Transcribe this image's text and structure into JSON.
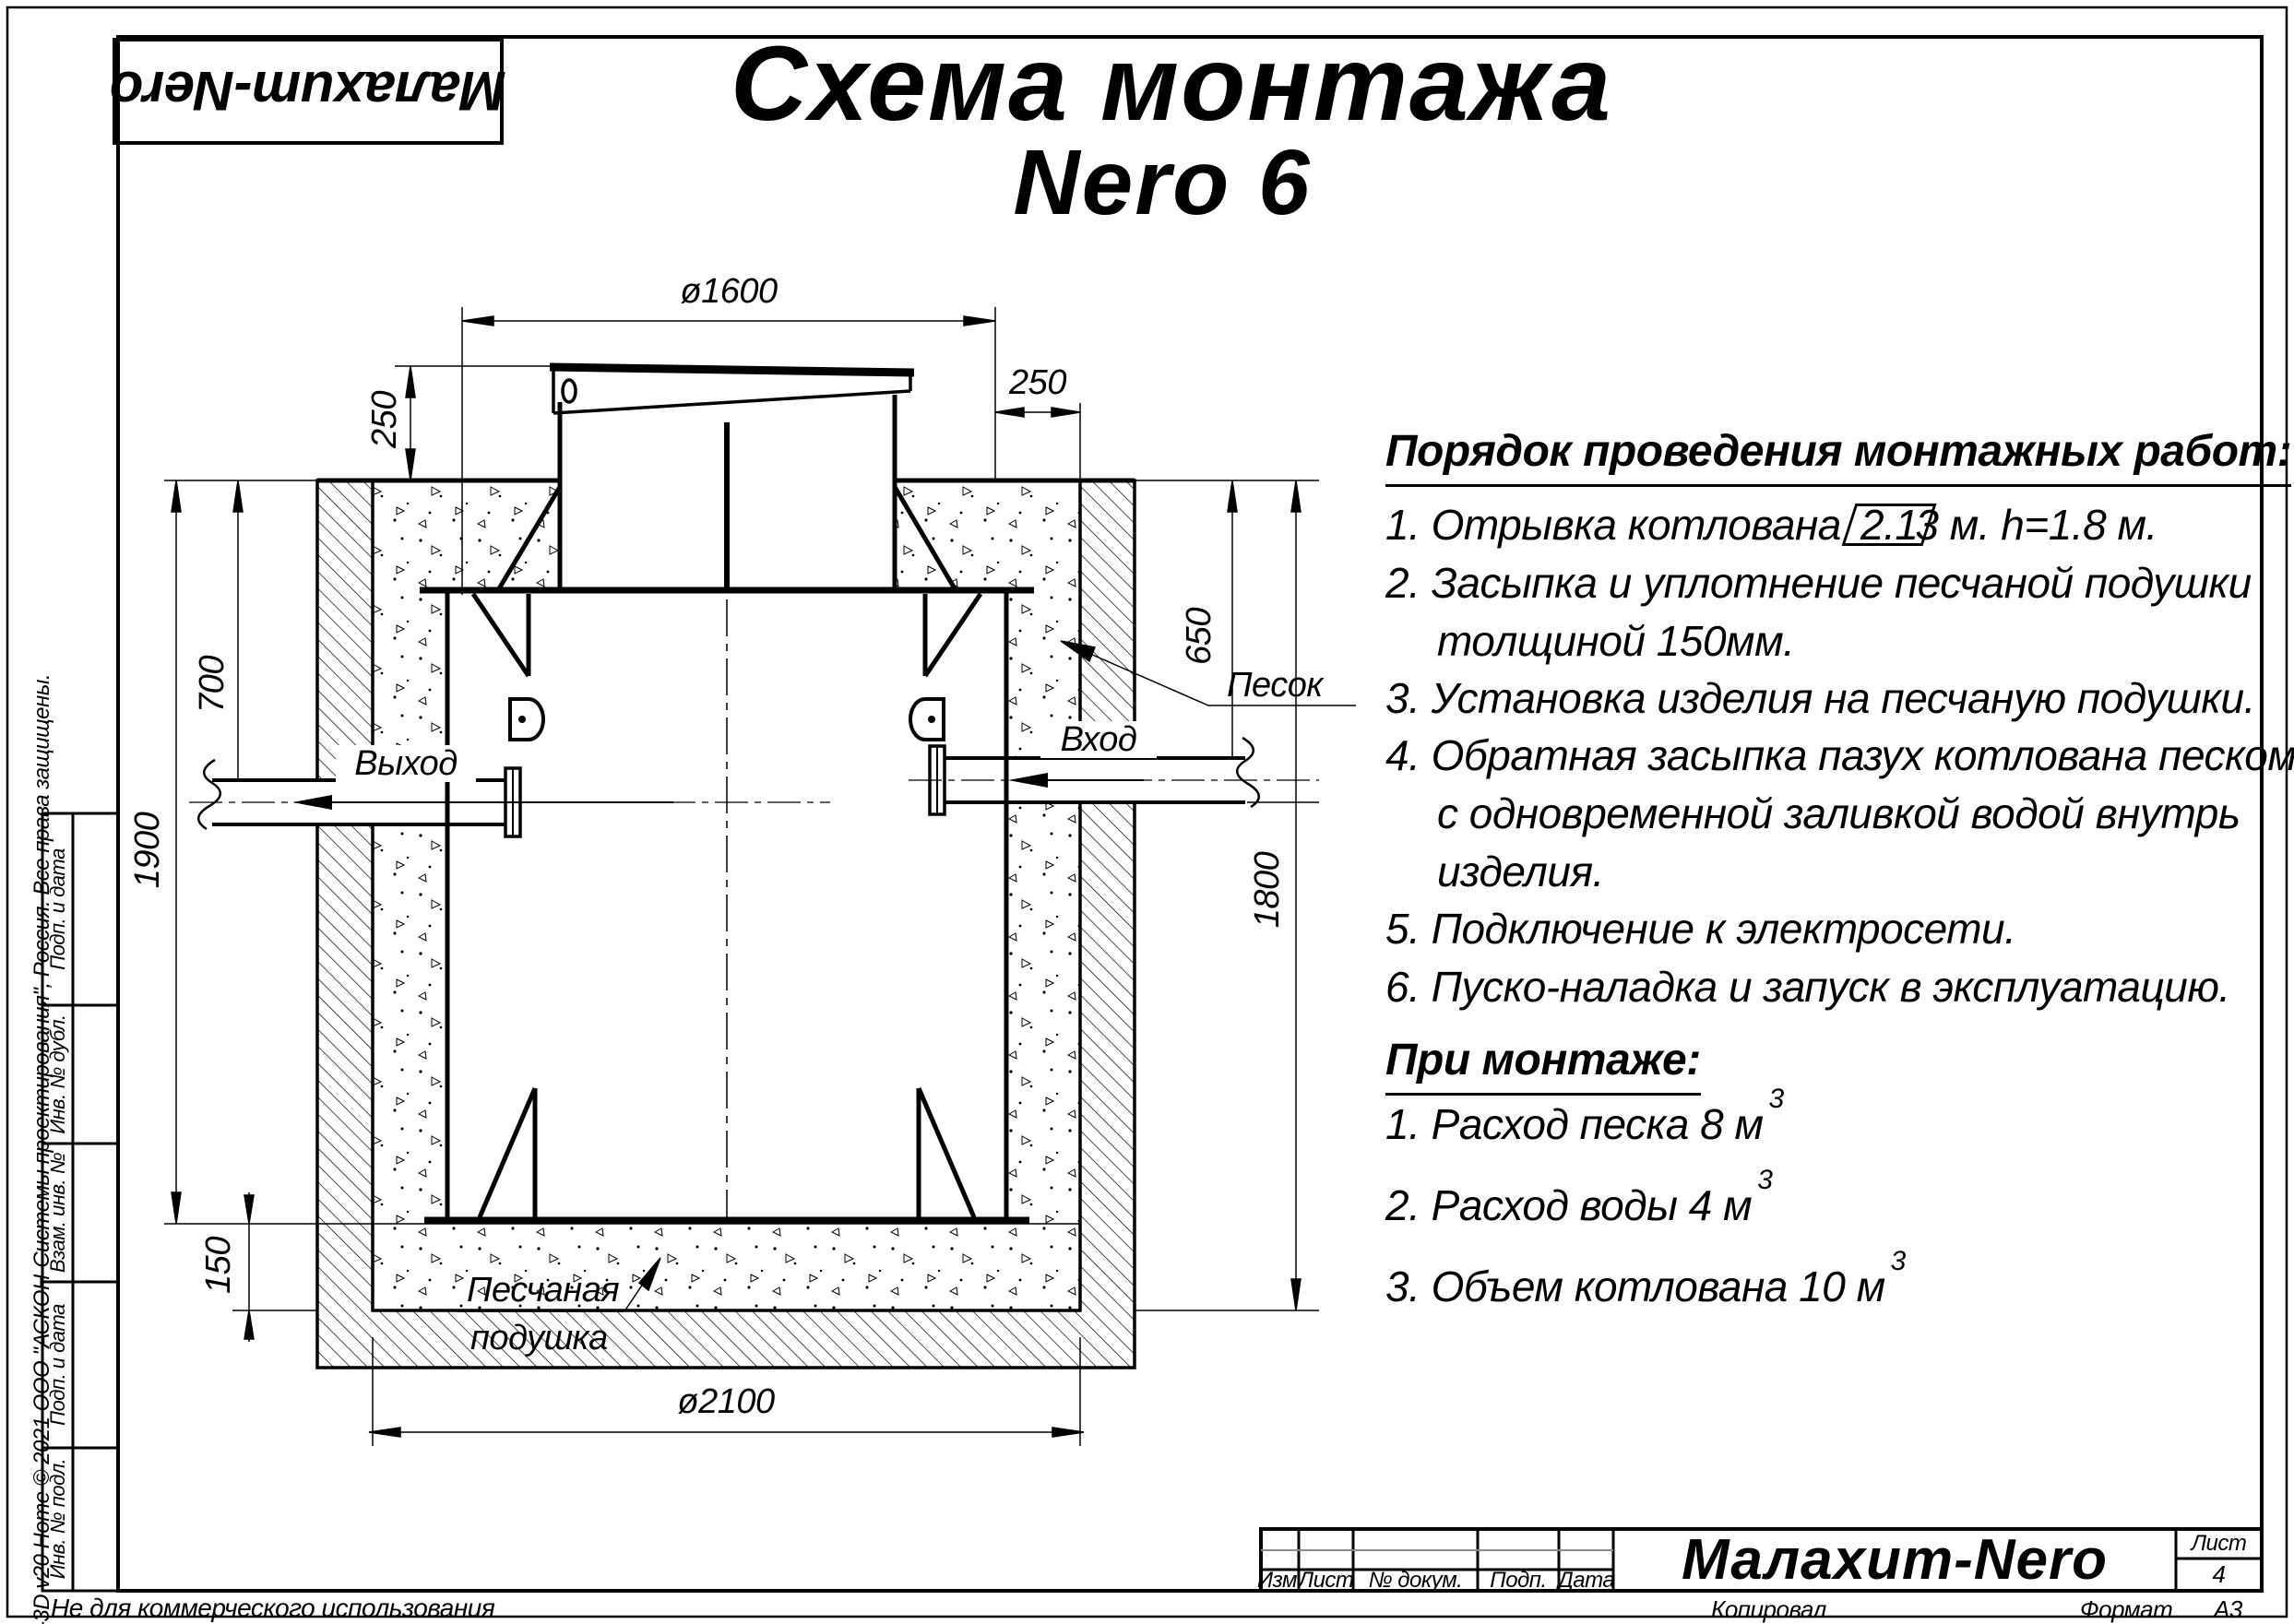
{
  "logo": {
    "text": "Малахит-Nero"
  },
  "title": {
    "line1": "Схема монтажа",
    "line2": "Nero 6"
  },
  "steps": {
    "heading": "Порядок проведения монтажных работ:",
    "s1_pre": "1. Отрывка котлована",
    "s1_box": "2.1",
    "s1_post": "3 м. h=1.8 м.",
    "s2a": "2. Засыпка и уплотнение песчаной подушки",
    "s2b": "толщиной 150мм.",
    "s3": "3. Установка изделия на песчаную подушки.",
    "s4a": "4. Обратная засыпка пазух котлована песком,",
    "s4b": "с одновременной заливкой водой внутрь",
    "s4c": "изделия.",
    "s5": "5. Подключение к электросети.",
    "s6": "6. Пуско-наладка и запуск в эксплуатацию."
  },
  "mounting": {
    "heading": "При монтаже:",
    "m1": "1. Расход песка 8 м",
    "m1_sup": "3",
    "m2": "2. Расход воды 4 м",
    "m2_sup": "3",
    "m3": "3. Объем котлована 10 м",
    "m3_sup": "3"
  },
  "dims": {
    "d1600": "ø1600",
    "d250_left": "250",
    "d250_right": "250",
    "d700": "700",
    "d1900": "1900",
    "d650": "650",
    "d1800": "1800",
    "d150": "150",
    "d2100": "ø2100"
  },
  "labels": {
    "outlet": "Выход",
    "inlet": "Вход",
    "sand": "Песок",
    "cushion_line1": "Песчаная",
    "cushion_line2": "подушка"
  },
  "stamp": {
    "cell1": "Подп. и дата",
    "cell2": "Инв. № дубл.",
    "cell3": "Взам. инв. №",
    "cell4": "Подп. и дата",
    "cell5": "Инв. № подл.",
    "kompas": "КОМПАС-3D v20 Home © 2021 ООО \"АСКОН-Системы проектирования\", Россия. Все права защищены.",
    "not_commercial": "Не для коммерческого использования"
  },
  "titleblock": {
    "col1": "Изм.",
    "col2": "Лист",
    "col3": "№ докум.",
    "col4": "Подп.",
    "col5": "Дата",
    "company": "Малахит-Nero",
    "sheet_label": "Лист",
    "sheet_number": "4",
    "copied": "Копировал",
    "format_label": "Формат",
    "format_value": "А3"
  },
  "colors": {
    "line": "#000000",
    "grid_gray": "#8a8a8a",
    "paper": "#ffffff"
  }
}
